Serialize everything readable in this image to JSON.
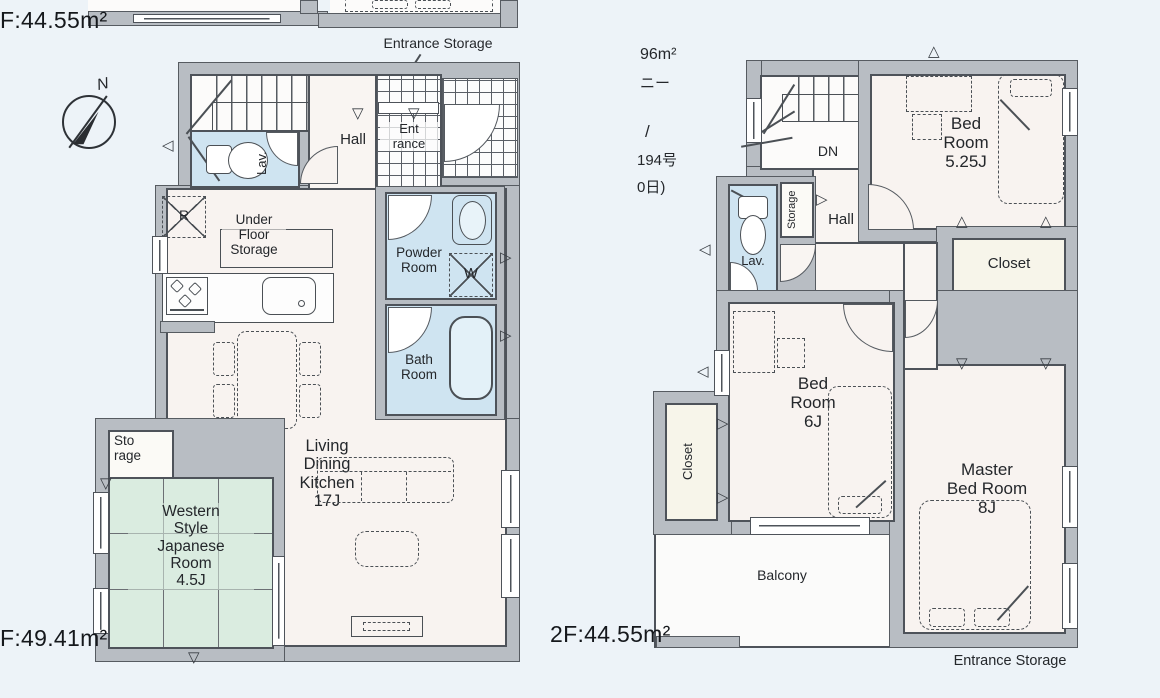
{
  "labels": {
    "top_area": "F:44.55m²",
    "f1_area": "F:49.41m²",
    "f2_area": "2F:44.55m²",
    "entrance_storage_top": "Entrance Storage",
    "entrance_storage_bottom": "Entrance Storage",
    "north": "N"
  },
  "floor1": {
    "up": "UP",
    "hall": "Hall",
    "lav": "Lav.",
    "entrance": "Ent\nrance",
    "fridge": "R",
    "under_floor_storage": "Under\nFloor\nStorage",
    "powder_room": "Powder\nRoom",
    "washer": "W",
    "bath_room": "Bath\nRoom",
    "ldk": "Living\nDining\nKitchen\n17J",
    "storage": "Sto\nrage",
    "japanese_room": "Western\nStyle\nJapanese\nRoom\n4.5J"
  },
  "floor2": {
    "fragments": {
      "l1": "96m²",
      "l2": "ニー",
      "l3": "/",
      "l4": "194号",
      "l5": "0日)"
    },
    "dn": "DN",
    "hall": "Hall",
    "storage": "Storage",
    "lav": "Lav.",
    "bedroom1": "Bed\nRoom\n5.25J",
    "closet1": "Closet",
    "closet2": "Closet",
    "closet3": "Closet",
    "bedroom2": "Bed\nRoom\n6J",
    "master": "Master\nBed Room\n8J",
    "balcony": "Balcony"
  },
  "icons": {
    "vent_up": "△",
    "vent_down": "▽",
    "vent_left": "◁",
    "vent_right": "▷"
  },
  "colors": {
    "wall": "#b8bdc3",
    "wet": "#cfe4f1",
    "tatami": "#daece0",
    "closet_fill": "#f7f5ea",
    "room": "#f8f3f0",
    "paper": "#edf3f8"
  }
}
